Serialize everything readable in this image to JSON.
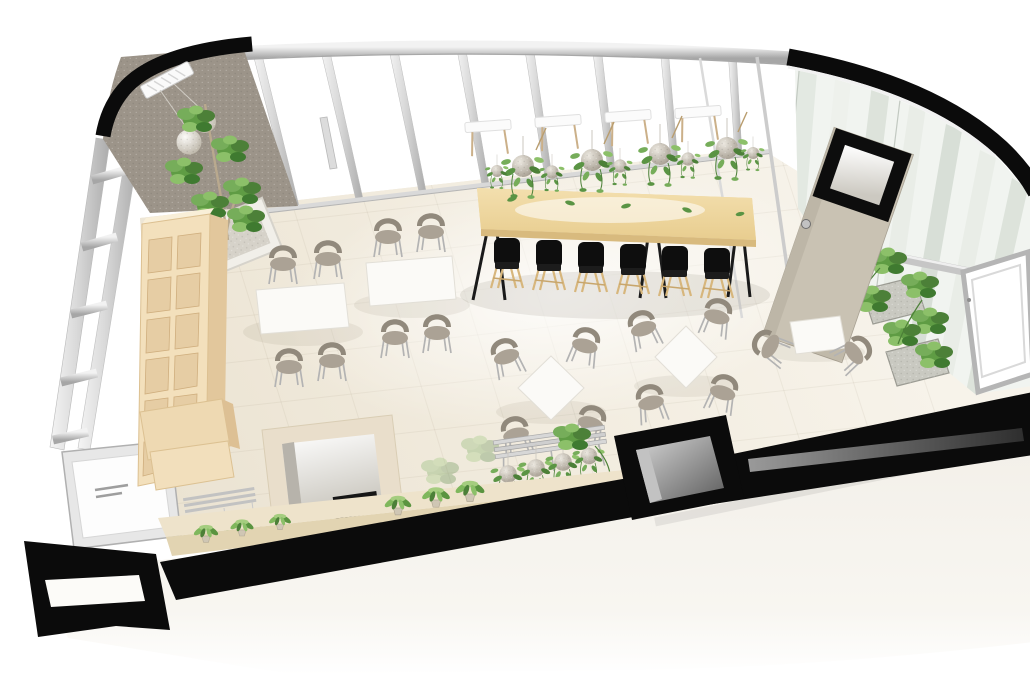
{
  "meta": {
    "title": "Axonometric 3D rendering of a cafe floor plan with curved glass facade",
    "view": "high-angle isometric interior render",
    "visible_text": "none"
  },
  "palette": {
    "outline_black": "#0b0b0b",
    "frame_silver": "#cfcfcf",
    "frame_silver_dark": "#9e9e9e",
    "wall_taupe": "#9c9489",
    "wood_shelf": "#f3e0bc",
    "wood_table": "#ecd49c",
    "floor_cream": "#efe9db",
    "floor_highlight": "#fbf9f4",
    "counter_beige": "#eee3cb",
    "door_beige": "#c9c2b3",
    "chair_taupe": "#9d968a",
    "chair_black": "#101010",
    "chair_wood": "#d9b97e",
    "plant_green": "#5f9c44",
    "plant_green_dark": "#3f7a30",
    "plant_green_light": "#8cc069",
    "moss_gray": "#b3aca1",
    "glass_tint": "#e4eae3",
    "slab_white": "#f3f0ea",
    "void_gray": "#8a8a8a"
  },
  "scene": {
    "room_shape": "rounded wedge: black outline wall, rounded top-left corner, quarter-circle glass corner top-right, thick black slab band along bottom",
    "walls": {
      "left": "glass curtain wall, two silver chords with five crossbars, white entry door at lower left",
      "top": "glass wall, silver head rail with eight vertical mullions",
      "top_left": "taupe textured accent wall",
      "right": "curved striped glass facade with silver beam, tilted open window, door with black square porthole"
    },
    "furniture": {
      "communal_table": {
        "material": "light wood",
        "black_chairs_near_side": 6,
        "white_chairs_far_side": 4
      },
      "rect_tables_left": {
        "count": 2,
        "chairs_each": 4
      },
      "diamond_tables_center": {
        "count": 2,
        "chairs_each": 4
      },
      "window_table_right": {
        "count": 1,
        "chairs": 2
      },
      "shelving_unit": "tall light-wood cubby shelf on left",
      "plant_bench": "silver slatted rack with 4 kokedama moss balls",
      "counter": "beige low counter along bottom wall with 6 small potted plants",
      "niche": "recessed alcove in bottom wall with dark screen"
    },
    "plants": {
      "hanging_kokedama_row": 8,
      "feature_tree_planter": 1,
      "right_planter_boxes": 2,
      "counter_pot_plants": 6
    },
    "lighting": {
      "pendant_globe_lamps": 2,
      "glass_jar_pendants": 2
    },
    "circulation": {
      "elevator_shaft_void": 1,
      "doors": 2
    }
  }
}
